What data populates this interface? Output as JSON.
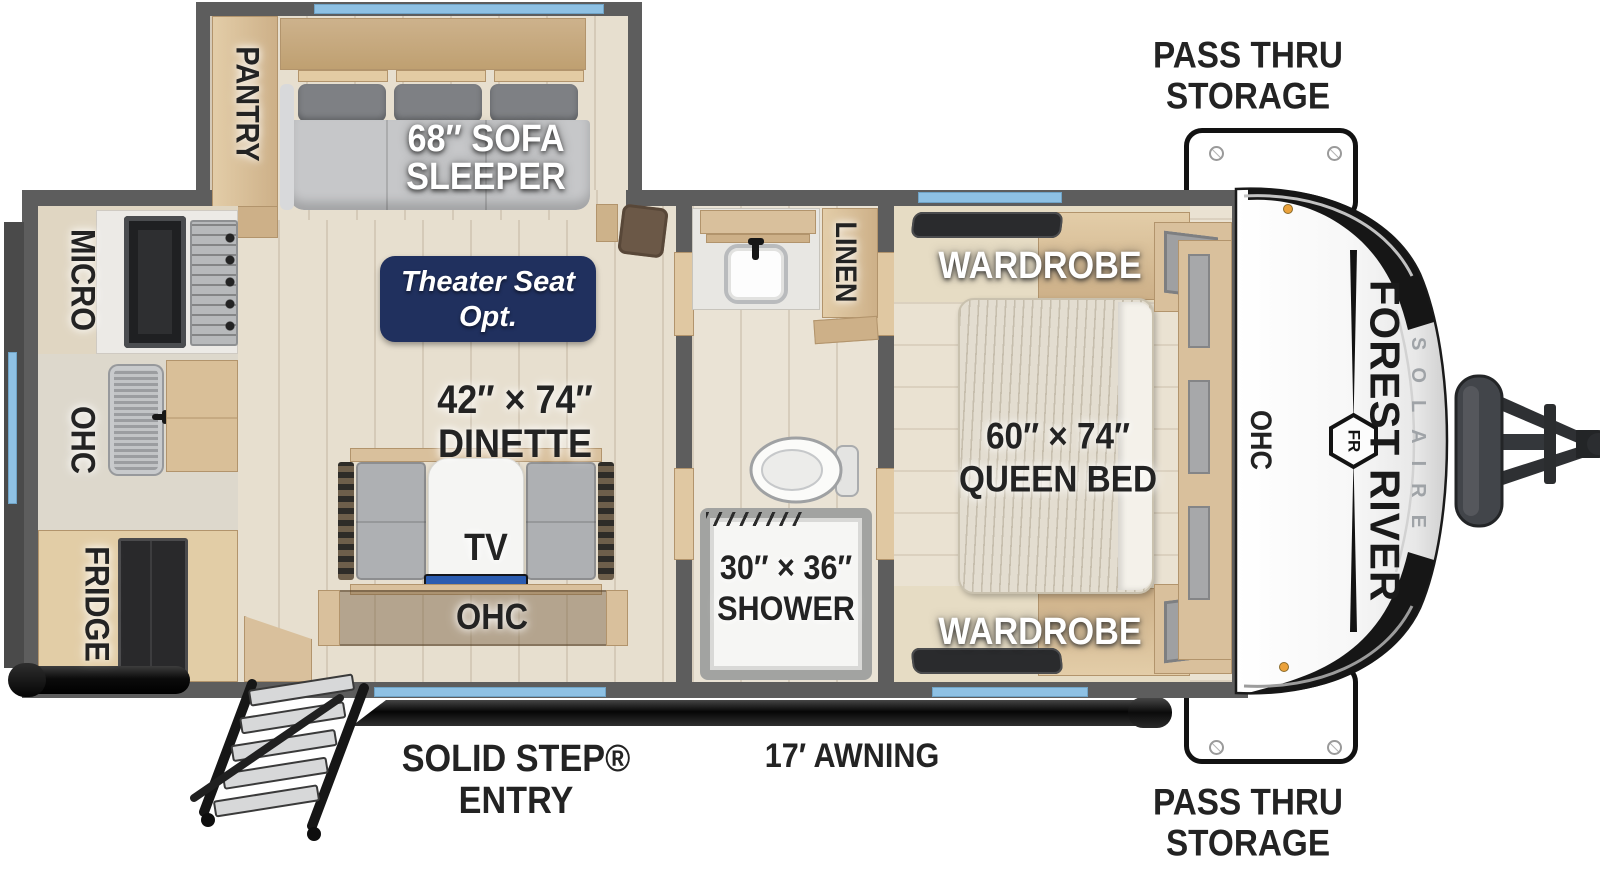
{
  "title": "Forest River Solaire travel trailer floor plan",
  "labels": {
    "pantry": "PANTRY",
    "sofa_line1": "68″ SOFA",
    "sofa_line2": "SLEEPER",
    "theater_line1": "Theater Seat",
    "theater_line2": "Opt.",
    "micro": "MICRO",
    "ohc_kitchen": "OHC",
    "fridge": "FRIDGE",
    "dinette_line1": "42″ × 74″",
    "dinette_line2": "DINETTE",
    "tv": "TV",
    "ohc_dinette": "OHC",
    "linen": "LINEN",
    "shower_line1": "30″ × 36″",
    "shower_line2": "SHOWER",
    "wardrobe_top": "WARDROBE",
    "wardrobe_bottom": "WARDROBE",
    "queen_line1": "60″ × 74″",
    "queen_line2": "QUEEN BED",
    "ohc_bedroom": "OHC",
    "pass_thru_top_line1": "PASS THRU",
    "pass_thru_top_line2": "STORAGE",
    "pass_thru_bottom_line1": "PASS THRU",
    "pass_thru_bottom_line2": "STORAGE",
    "entry_line1": "SOLID STEP®",
    "entry_line2": "ENTRY",
    "awning": "17′ AWNING"
  },
  "brand": {
    "name": "FOREST RIVER",
    "model": "SOLAIRE",
    "logo_monogram": "FR"
  },
  "colors": {
    "wall_gray": "#5d5d5d",
    "window_blue": "#8ec1e4",
    "theater_badge_navy": "#20305e",
    "cabinet_wood": "#d9c09c",
    "floor_tan": "#e7dfcf",
    "awning_black": "#111111",
    "front_cap_white": "#ffffff",
    "clearance_light_amber": "#eba23b"
  }
}
